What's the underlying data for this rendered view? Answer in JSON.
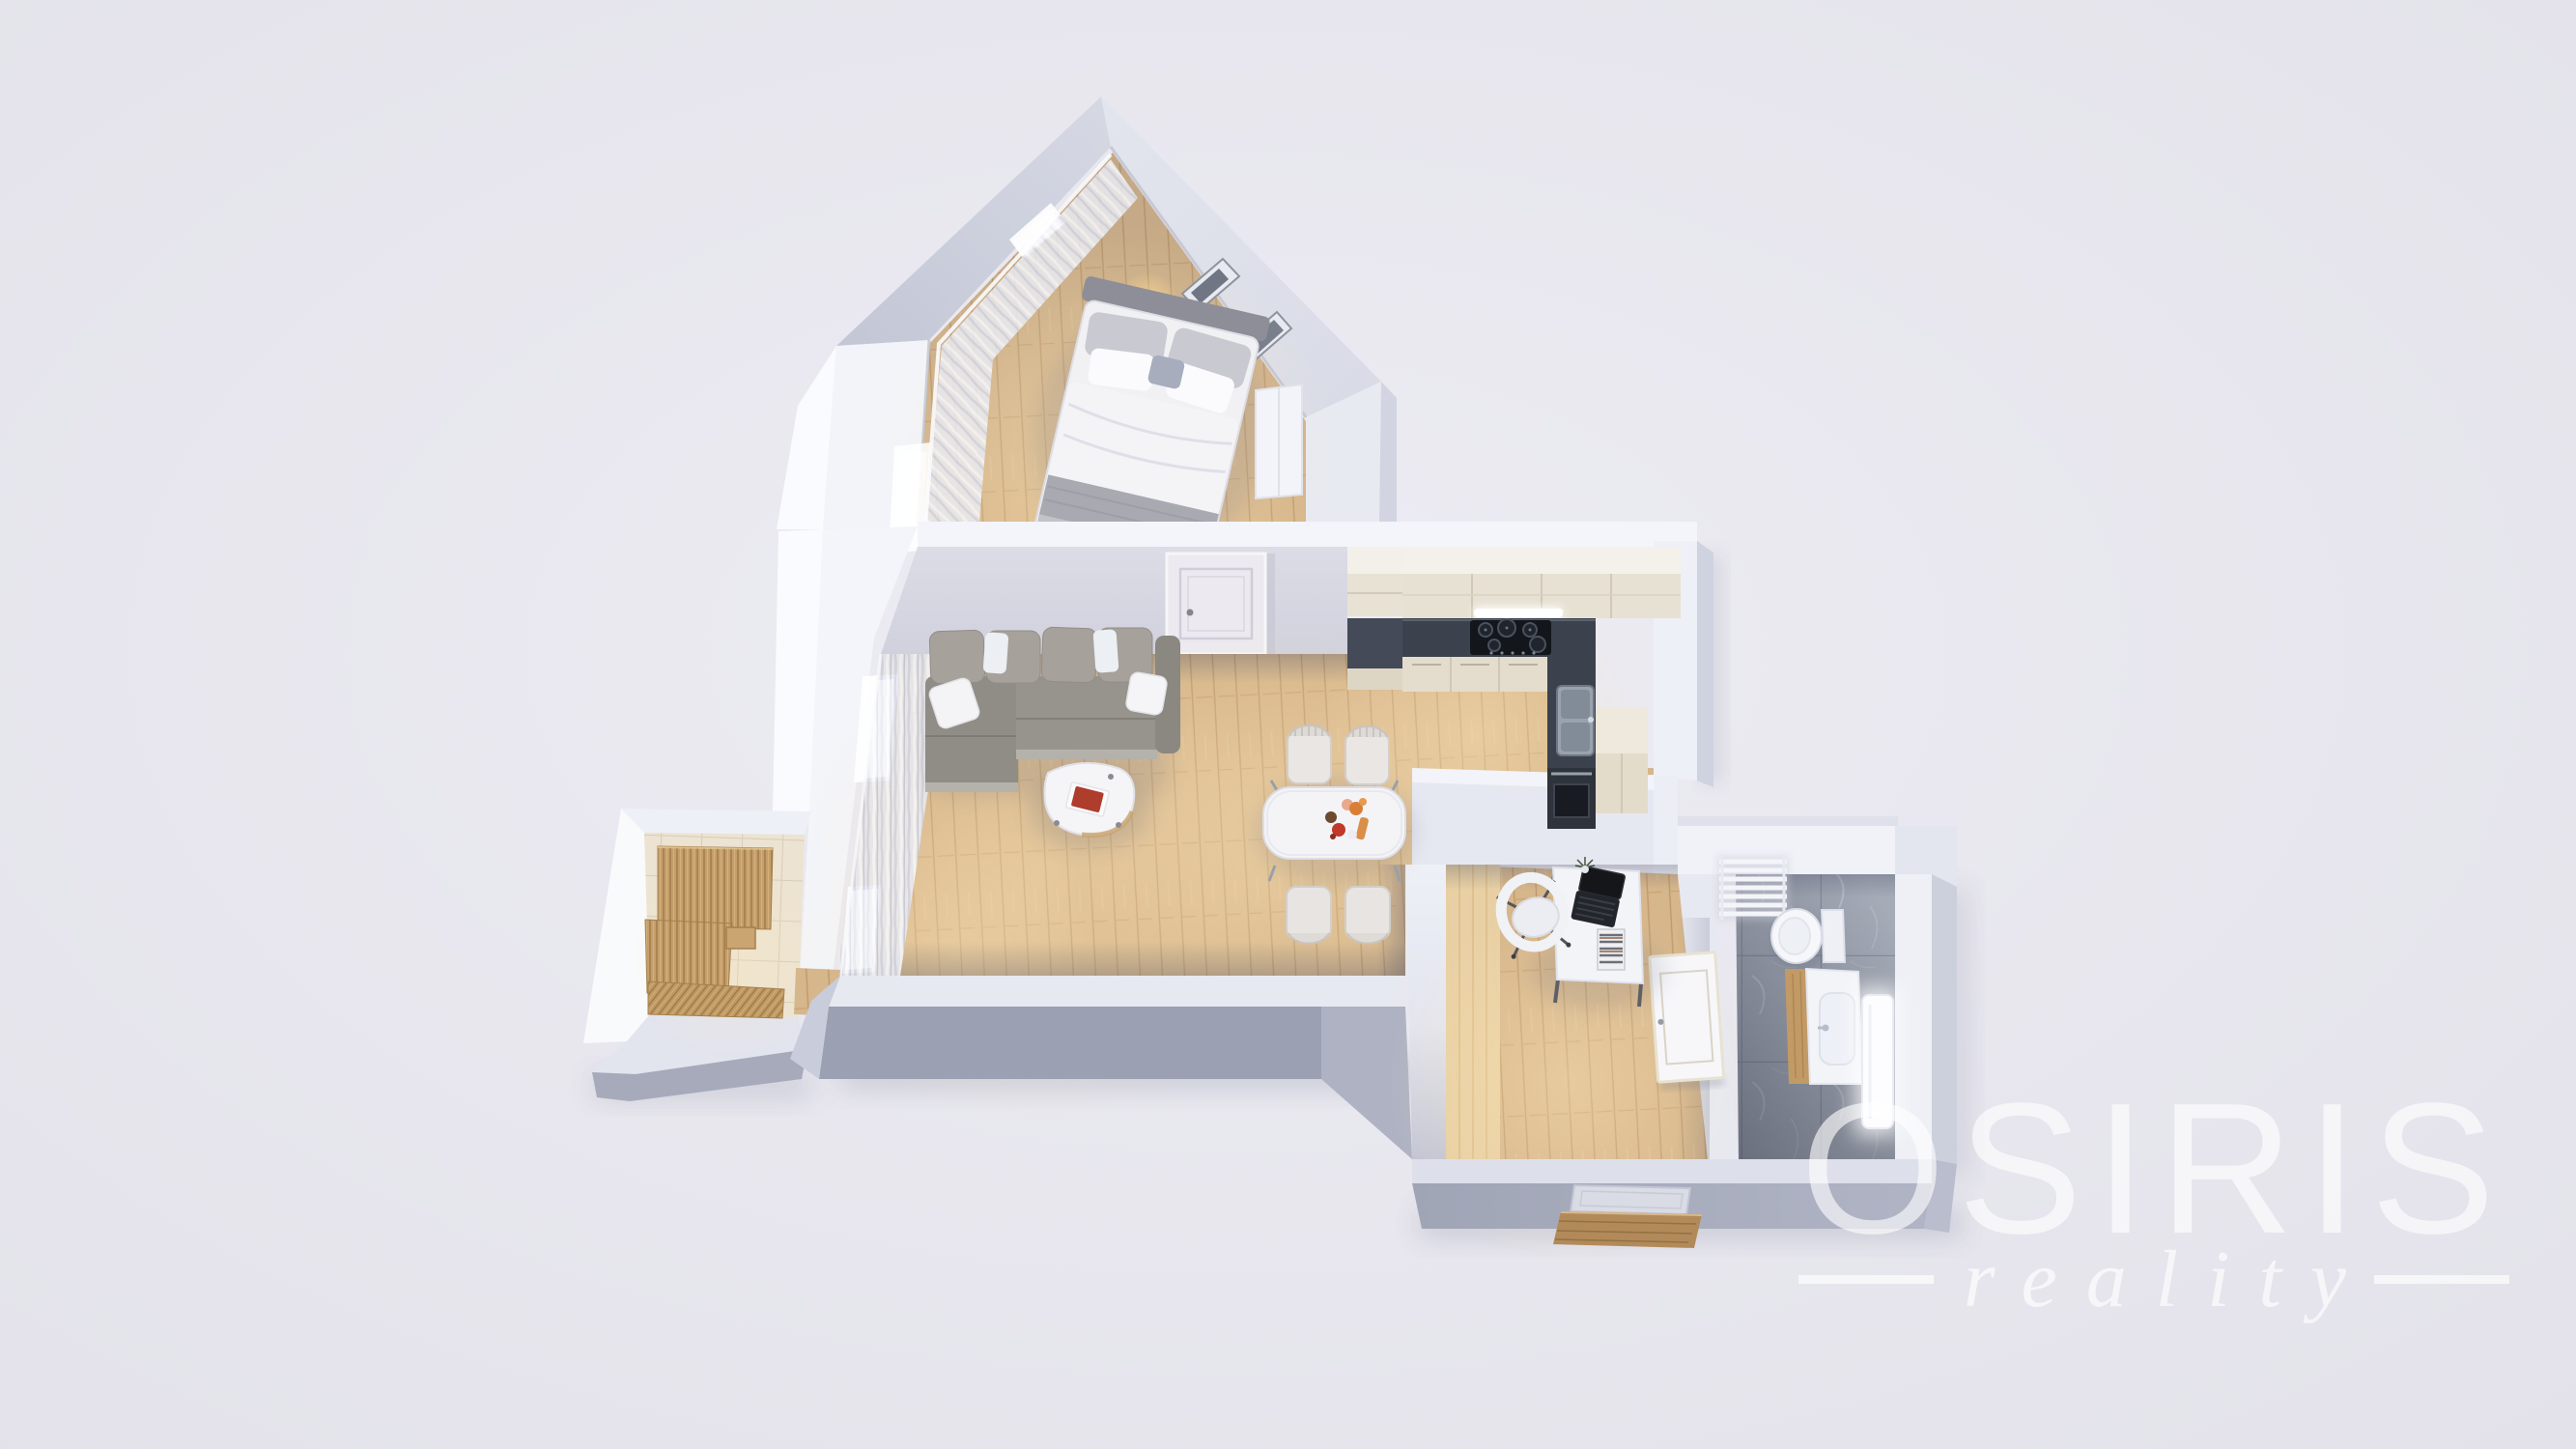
{
  "watermark": {
    "title": "OSIRIS",
    "subtitle": "reality"
  },
  "palette": {
    "background": "#e5e4ec",
    "wall_bright": "#f3f5fa",
    "wall_shadow_south": "#9ba0b2",
    "wood_floor": "#d5b488",
    "kitchen_counter_dark": "#3c424d",
    "cabinet_cream": "#e7e1d3",
    "wardrobe_oak": "#c49f6b",
    "entry_tile": "#ece2d0",
    "bathroom_marble": "#a4aab6",
    "sofa_gray": "#97938d",
    "book_red": "#ae3d2c",
    "lamp_gold": "#c9a35f",
    "watermark_white": "#ffffff"
  }
}
